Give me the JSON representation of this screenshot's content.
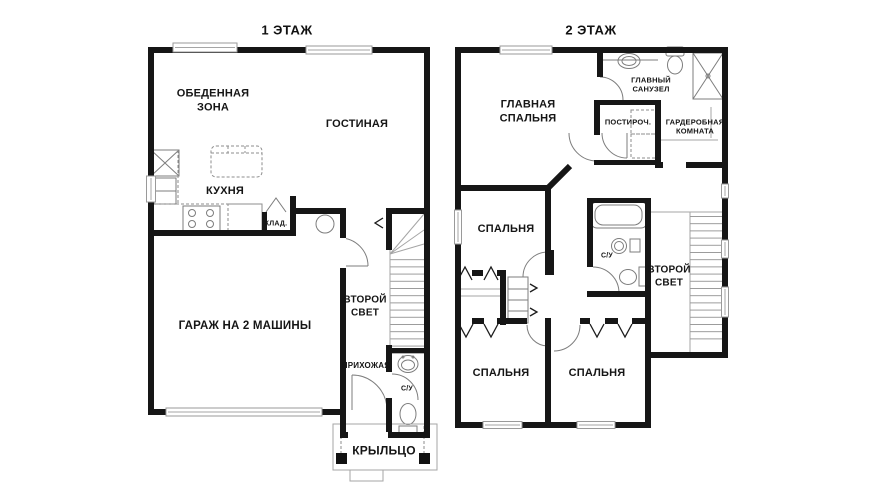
{
  "document": {
    "type": "floor-plan",
    "background": "#ffffff",
    "wall_color": "#161616",
    "fixture_line_color": "#7d7d7d"
  },
  "floor1": {
    "title": "1 ЭТАЖ",
    "rooms": {
      "dining": "ОБЕДЕННАЯ\nЗОНА",
      "living": "ГОСТИНАЯ",
      "kitchen": "КУХНЯ",
      "pantry": "КЛАД.",
      "garage": "ГАРАЖ НА 2 МАШИНЫ",
      "second_light": "ВТОРОЙ\nСВЕТ",
      "hallway": "ПРИХОЖАЯ",
      "wc": "С/У",
      "porch": "КРЫЛЬЦО"
    }
  },
  "floor2": {
    "title": "2 ЭТАЖ",
    "rooms": {
      "master_bedroom": "ГЛАВНАЯ\nСПАЛЬНЯ",
      "master_bath": "ГЛАВНЫЙ\nСАНУЗЕЛ",
      "laundry": "ПОСТИРОЧ.",
      "wardrobe": "ГАРДЕРОБНАЯ\nКОМНАТА",
      "bedroom_mid": "СПАЛЬНЯ",
      "wc": "С/У",
      "second_light": "ВТОРОЙ\nСВЕТ",
      "bedroom_left": "СПАЛЬНЯ",
      "bedroom_right": "СПАЛЬНЯ"
    }
  }
}
